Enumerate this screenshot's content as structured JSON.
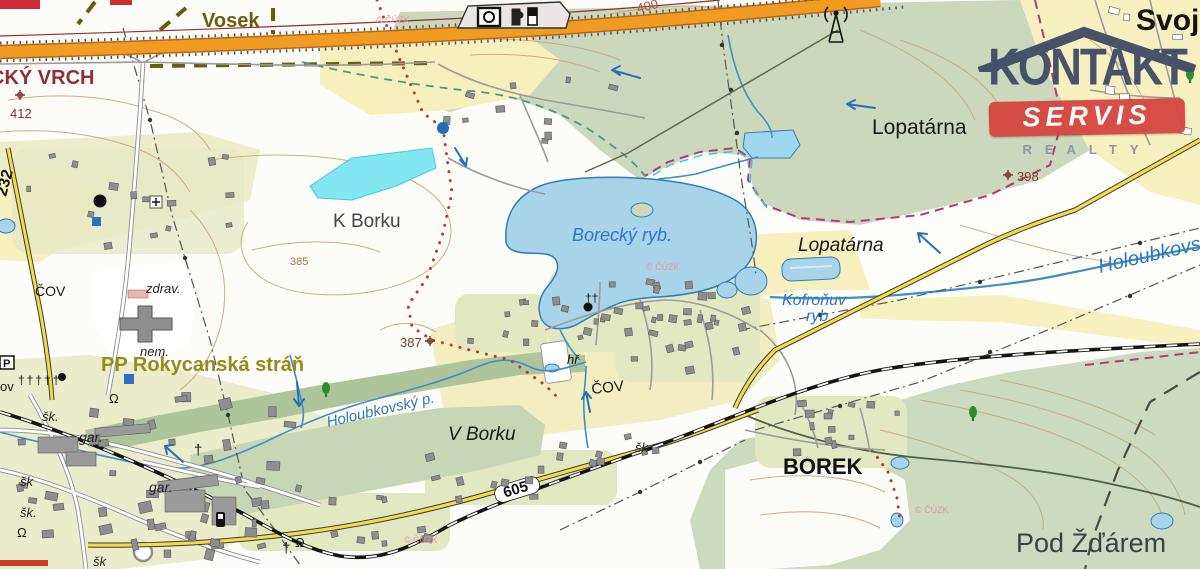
{
  "title": "Topographic cadastral map – Borek / Rokycany area",
  "watermark": {
    "line1": "KONTAKT",
    "line2": "SERVIS",
    "line3": "REALTY"
  },
  "colors": {
    "logo_navy": "#3f4b66",
    "logo_red": "#d64541",
    "logo_gray": "#8d939c",
    "highway_orange": "#f19c20",
    "road_yellow": "#f0dd4a",
    "water_fill": "#a9d3e9",
    "water_line": "#2e7fb8",
    "flood_cyan": "#82e7f0",
    "forest_green": "#cbd8bb",
    "field_yellow": "#f7f0c0",
    "town_base": "#ebeccb",
    "garden_green": "#e2e8c2",
    "contour_brown": "#c9a67e",
    "copyright_pink": "#e895a5"
  },
  "map": {
    "copyright": "© ČÚZK",
    "labels": [
      {
        "name": "town-svojkovice",
        "text": "Svoj",
        "x": 1136,
        "y": 30,
        "size": 30,
        "color": "#141414",
        "weight": "bold"
      },
      {
        "name": "area-vosek",
        "text": "Vosek",
        "x": 202,
        "y": 27,
        "size": 20,
        "color": "#6b5c12",
        "weight": "bold"
      },
      {
        "name": "hill-vrch",
        "text": "CKÝ VRCH",
        "x": -10,
        "y": 84,
        "size": 20,
        "color": "#8d2f34",
        "weight": "bold"
      },
      {
        "name": "elev-412",
        "text": "412",
        "x": 10,
        "y": 118,
        "size": 13,
        "color": "#8d2f34"
      },
      {
        "name": "road-232",
        "text": "232",
        "x": 6,
        "y": 197,
        "size": 16,
        "color": "#141414",
        "weight": "bold",
        "rotate": -75
      },
      {
        "name": "field-k-borku",
        "text": "K Borku",
        "x": 333,
        "y": 227,
        "size": 19,
        "color": "#474747"
      },
      {
        "name": "pond-borecky",
        "text": "Borecký ryb.",
        "x": 572,
        "y": 241,
        "size": 18,
        "color": "#2f78c0",
        "style": "italic"
      },
      {
        "name": "area-lopatarna-north",
        "text": "Lopatárna",
        "x": 872,
        "y": 134,
        "size": 21,
        "color": "#1a1a1a"
      },
      {
        "name": "area-lopatarna-valley",
        "text": "Lopatárna",
        "x": 798,
        "y": 251,
        "size": 19,
        "color": "#1a1a1a",
        "style": "italic"
      },
      {
        "name": "pond-kofronuv-line1",
        "text": "Kofroňuv",
        "x": 782,
        "y": 305,
        "size": 16,
        "color": "#2f78c0",
        "style": "italic"
      },
      {
        "name": "pond-kofronuv-line2",
        "text": "ryb",
        "x": 806,
        "y": 321,
        "size": 16,
        "color": "#2f78c0",
        "style": "italic"
      },
      {
        "name": "river-holoubkovsky",
        "text": "Holoubkovský",
        "x": 1100,
        "y": 273,
        "size": 20,
        "color": "#2f78c0",
        "style": "italic",
        "rotate": -13
      },
      {
        "name": "stream-holoubkovsky-p",
        "text": "Holoubkovský p.",
        "x": 328,
        "y": 427,
        "size": 15,
        "color": "#2f78c0",
        "style": "italic",
        "rotate": -13
      },
      {
        "name": "reserve-pp-rokycanska-stran",
        "text": "PP Rokycanská stráň",
        "x": 101,
        "y": 371,
        "size": 20,
        "color": "#948c1a",
        "weight": "bold"
      },
      {
        "name": "label-zdrav",
        "text": "zdrav.",
        "x": 146,
        "y": 293,
        "size": 13,
        "color": "#222222",
        "style": "italic"
      },
      {
        "name": "label-nem",
        "text": "nem.",
        "x": 140,
        "y": 356,
        "size": 13,
        "color": "#222222",
        "style": "italic"
      },
      {
        "name": "label-cov-west",
        "text": "ČOV",
        "x": 35,
        "y": 296,
        "size": 14,
        "color": "#141414"
      },
      {
        "name": "label-cov-village",
        "text": "ČOV",
        "x": 592,
        "y": 394,
        "size": 15,
        "color": "#141414",
        "rotate": -6
      },
      {
        "name": "label-hriste",
        "text": "hř",
        "x": 567,
        "y": 364,
        "size": 13,
        "color": "#141414",
        "style": "italic"
      },
      {
        "name": "area-v-borku",
        "text": "V Borku",
        "x": 448,
        "y": 440,
        "size": 19,
        "color": "#1a1a1a",
        "style": "italic"
      },
      {
        "name": "village-borek",
        "text": "BOREK",
        "x": 783,
        "y": 474,
        "size": 22,
        "color": "#111111",
        "weight": "bold"
      },
      {
        "name": "area-pod-zdarem",
        "text": "Pod Žďárem",
        "x": 1016,
        "y": 552,
        "size": 27,
        "color": "#3c4146"
      },
      {
        "name": "elev-398",
        "text": "398",
        "x": 1017,
        "y": 181,
        "size": 13,
        "color": "#7a3b2e"
      },
      {
        "name": "elev-400",
        "text": "400",
        "x": 638,
        "y": 13,
        "size": 13,
        "color": "#a1543a",
        "rotate": -14
      },
      {
        "name": "elev-385",
        "text": "385",
        "x": 290,
        "y": 265,
        "size": 11,
        "color": "#b0703c"
      },
      {
        "name": "elev-387",
        "text": "387",
        "x": 400,
        "y": 347,
        "size": 13,
        "color": "#7a3b2e"
      },
      {
        "name": "road-605",
        "text": "605",
        "x": 517,
        "y": 494,
        "size": 15,
        "color": "#111111",
        "weight": "bold",
        "rotate": -17,
        "anchor": "middle"
      },
      {
        "name": "label-skola-1",
        "text": "šk.",
        "x": 42,
        "y": 421,
        "size": 13,
        "color": "#222222",
        "style": "italic"
      },
      {
        "name": "label-skola-2",
        "text": "šk",
        "x": 20,
        "y": 486,
        "size": 13,
        "color": "#222222",
        "style": "italic"
      },
      {
        "name": "label-skola-3",
        "text": "šk.",
        "x": 20,
        "y": 517,
        "size": 13,
        "color": "#222222",
        "style": "italic"
      },
      {
        "name": "label-skola-4",
        "text": "šk",
        "x": 93,
        "y": 566,
        "size": 13,
        "color": "#222222",
        "style": "italic"
      },
      {
        "name": "label-skola-5",
        "text": "šk",
        "x": 635,
        "y": 452,
        "size": 13,
        "color": "#222222",
        "style": "italic"
      },
      {
        "name": "label-garaze-1",
        "text": "gar.",
        "x": 79,
        "y": 442,
        "size": 14,
        "color": "#222222",
        "style": "italic"
      },
      {
        "name": "label-garaze-2",
        "text": "gar.",
        "x": 149,
        "y": 492,
        "size": 14,
        "color": "#222222",
        "style": "italic"
      },
      {
        "name": "label-ov-cut",
        "text": "ov",
        "x": 0,
        "y": 391,
        "size": 13,
        "color": "#141414"
      },
      {
        "name": "omega-symbol-1",
        "text": "Ω",
        "x": 109,
        "y": 403,
        "size": 13,
        "color": "#141414"
      },
      {
        "name": "omega-symbol-2",
        "text": "Ω",
        "x": 17,
        "y": 537,
        "size": 13,
        "color": "#141414"
      },
      {
        "name": "omega-symbol-3",
        "text": "Ω",
        "x": 295,
        "y": 547,
        "size": 13,
        "color": "#141414"
      },
      {
        "name": "cemetery-cross-row",
        "text": "†††††",
        "x": 18,
        "y": 384,
        "size": 12,
        "color": "#141414",
        "ls": 2
      },
      {
        "name": "cross-symbol-a",
        "text": "†",
        "x": 194,
        "y": 455,
        "size": 15,
        "color": "#141414"
      },
      {
        "name": "cross-symbol-b",
        "text": "†",
        "x": 282,
        "y": 553,
        "size": 15,
        "color": "#141414"
      },
      {
        "name": "church-cross-symbol",
        "text": "††",
        "x": 585,
        "y": 302,
        "size": 12,
        "color": "#141414"
      },
      {
        "name": "parking-symbol-label",
        "text": "P",
        "x": 3,
        "y": 367,
        "size": 11,
        "color": "#141414",
        "weight": "bold"
      },
      {
        "name": "copyright-1",
        "text": "© ČÚZK",
        "x": 376,
        "y": 23,
        "size": 9,
        "color": "#e895a5"
      },
      {
        "name": "copyright-2",
        "text": "© ČÚZK",
        "x": 646,
        "y": 270,
        "size": 9,
        "color": "#e895a5"
      },
      {
        "name": "copyright-3",
        "text": "© ČÚZK",
        "x": 915,
        "y": 513,
        "size": 9,
        "color": "#e895a5"
      },
      {
        "name": "copyright-4",
        "text": "© ČÚZK",
        "x": 404,
        "y": 543,
        "size": 9,
        "color": "#e895a5"
      }
    ]
  }
}
